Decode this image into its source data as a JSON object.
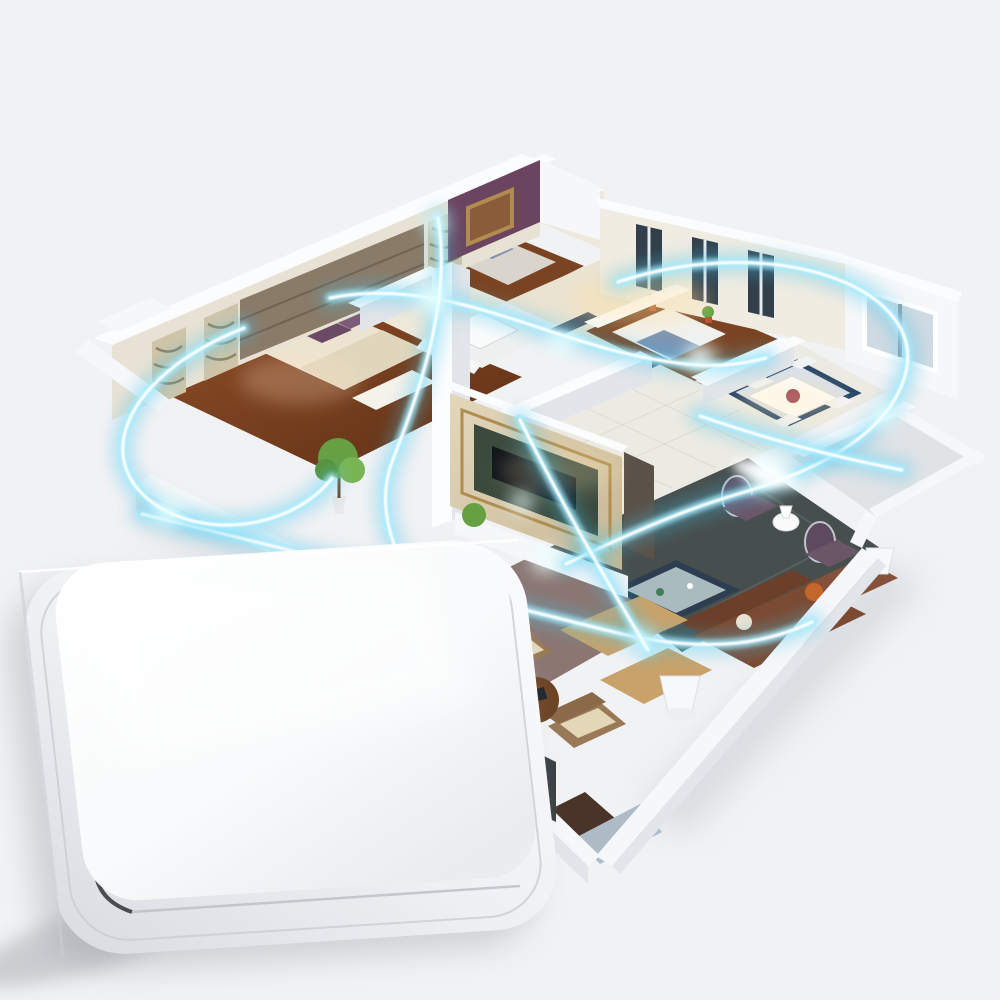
{
  "image": {
    "kind": "product-photo-render",
    "description": "Isometric 3D cutaway render of an apartment floor plan with glowing cyan wireless-signal beams sweeping through the rooms; a large white rounded-square wireless wall switch sits tilted in the bottom-left foreground on a light gray background",
    "background_color": "#f1f2f4"
  },
  "colors": {
    "background": "#f1f2f4",
    "wall_white": "#f5f7f9",
    "wall_shade": "#e2e5e9",
    "marble_floor": "#eae3d2",
    "entry_marble": "#efe9da",
    "tile_floor": "#ebeae3",
    "wood_floor_dark": "#6b3a1c",
    "slate_rug": "#474f4e",
    "nook_floor": "#8b7672",
    "terrace_floor": "#e0e3e6",
    "bath_floor": "#eef0ef",
    "purple_wall": "#6b4560",
    "headboard_panel": "#8a7a68",
    "zebra_panel": "#cfc4a8",
    "bed_cream": "#ece4d0",
    "pillow_purple": "#6b4a66",
    "sofa_brown": "#7b4a33",
    "ottoman_tan": "#c9a26a",
    "side_table_wood": "#6e4426",
    "plant_green": "#67a043",
    "window_glass": "#cfdae2",
    "window_frame": "#32404c",
    "rug_border": "#2a4768",
    "gold_trim": "#b08c4f",
    "tv_black": "#10151a",
    "signal_core": "#ffffff",
    "signal_glow": "#a5ecff",
    "signal_outer": "#45c2e8",
    "switch_button": "#ffffff",
    "switch_plate": "#e3e6ea",
    "switch_seam": "#2f3235",
    "shadow": "#b3b7bd"
  },
  "scene": {
    "style": "isometric cutaway apartment render, viewed from above at an angle",
    "rooms": [
      {
        "name": "master-bedroom",
        "floor": "dark wood",
        "contents": [
          "cream tufted double bed",
          "two purple pillows",
          "padded brown headboard wall",
          "zebra-pattern wardrobe pillars",
          "white nightstands with lamps",
          "white foot bench",
          "green potted plant"
        ]
      },
      {
        "name": "second-bedroom",
        "floor": "wood",
        "contents": [
          "purple damask accent wall",
          "gold framed picture",
          "bed with striped pillows",
          "white nightstands"
        ]
      },
      {
        "name": "bathroom",
        "floor": "white tile",
        "contents": [
          "bathtub",
          "round washbasin",
          "toilet"
        ]
      },
      {
        "name": "hallway-kitchen",
        "floor": "beige marble",
        "contents": [
          "tall dark-framed windows",
          "potted plants",
          "white counters",
          "dark door thresholds"
        ]
      },
      {
        "name": "third-bedroom",
        "floor": "wood",
        "contents": [
          "white bed with blue throw",
          "dark headboard"
        ]
      },
      {
        "name": "dining-room",
        "floor": "tile with blue-bordered rug",
        "contents": [
          "white dining table",
          "red centerpiece",
          "white chairs",
          "large exterior window"
        ]
      },
      {
        "name": "living-room",
        "floor": "tile with dark slate rug",
        "contents": [
          "marble TV feature wall with gold trim",
          "flat screen TV",
          "white media console",
          "brown leather sofa with orange cushion",
          "glass-top coffee table",
          "two purple round-back armchairs",
          "tan ottomans",
          "white floor lamps"
        ]
      },
      {
        "name": "sitting-nook",
        "floor": "mauve",
        "contents": [
          "two beige wingback armchairs",
          "round wooden side table with books"
        ]
      },
      {
        "name": "terrace",
        "floor": "light gray slab",
        "contents": [
          "white rim walls"
        ]
      }
    ],
    "signal": {
      "description": "glowing energy beams with white cores and cyan halos crossing the floor plan, plus a large arc sweeping around the right wing and bright flares where beams meet walls",
      "beam_count": 7
    },
    "device": {
      "type": "wireless smart wall switch",
      "shape": "large rounded-square rocker button on a rounded base plate",
      "color": "glossy white",
      "pose": "tilted diamond-like, overlapping the lower-left of the floor plan",
      "details": [
        "soft drop shadow to the lower left",
        "dark seam visible at the lower corner between button and frame"
      ]
    }
  }
}
